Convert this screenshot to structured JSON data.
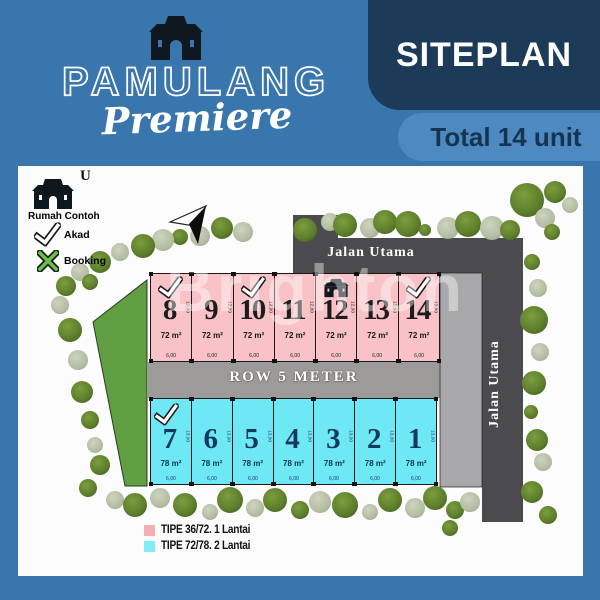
{
  "brand": {
    "name": "PAMULANG",
    "sub": "Premiere"
  },
  "header": {
    "title": "SITEPLAN",
    "subtitle": "Total 14 unit"
  },
  "legend": {
    "rumah_contoh": "Rumah Contoh",
    "akad": "Akad",
    "booking": "Booking"
  },
  "compass": {
    "label": "U"
  },
  "roads": {
    "top": "Jalan Utama",
    "right": "Jalan Utama",
    "middle": "ROW 5 METER"
  },
  "watermark": "Brighton",
  "rows": {
    "pink": {
      "area": "72 m²",
      "depth": "12,00",
      "width": "6,00",
      "units": [
        {
          "number": "8",
          "marker": "akad"
        },
        {
          "number": "9",
          "marker": null
        },
        {
          "number": "10",
          "marker": "akad"
        },
        {
          "number": "11",
          "marker": null
        },
        {
          "number": "12",
          "marker": "contoh"
        },
        {
          "number": "13",
          "marker": null
        },
        {
          "number": "14",
          "marker": "akad"
        }
      ]
    },
    "cyan": {
      "area": "78 m²",
      "depth": "13,00",
      "width": "6,00",
      "units": [
        {
          "number": "7",
          "marker": "akad"
        },
        {
          "number": "6",
          "marker": null
        },
        {
          "number": "5",
          "marker": null
        },
        {
          "number": "4",
          "marker": null
        },
        {
          "number": "3",
          "marker": null
        },
        {
          "number": "2",
          "marker": null
        },
        {
          "number": "1",
          "marker": null
        }
      ]
    }
  },
  "type_legend": [
    {
      "swatch_color": "#f5aeb4",
      "label": "TIPE 36/72. 1 Lantai"
    },
    {
      "swatch_color": "#7deef8",
      "label": "TIPE 72/78. 2 Lantai"
    }
  ],
  "colors": {
    "background_blue": "#3a76ae",
    "dark_navy": "#1c3b58",
    "total_box_blue": "#4c8ac1",
    "pink_unit": "#f8c2c7",
    "cyan_unit": "#6fe8f6",
    "main_road_gray": "#4b4b4f",
    "row_road_gray": "#9d9b99",
    "green_area": "#5f9e41"
  },
  "trees": [
    [
      287,
      64,
      12,
      "d"
    ],
    [
      312,
      56,
      9,
      "s"
    ],
    [
      327,
      59,
      12,
      "d"
    ],
    [
      352,
      62,
      10,
      "s"
    ],
    [
      367,
      56,
      12,
      "d"
    ],
    [
      390,
      58,
      13,
      "d"
    ],
    [
      407,
      64,
      6,
      "d"
    ],
    [
      430,
      62,
      11,
      "s"
    ],
    [
      450,
      58,
      13,
      "d"
    ],
    [
      474,
      62,
      12,
      "s"
    ],
    [
      492,
      64,
      10,
      "d"
    ],
    [
      509,
      34,
      17,
      "d"
    ],
    [
      527,
      52,
      10,
      "s"
    ],
    [
      534,
      66,
      8,
      "d"
    ],
    [
      537,
      26,
      11,
      "d"
    ],
    [
      552,
      39,
      8,
      "s"
    ],
    [
      514,
      96,
      8,
      "d"
    ],
    [
      520,
      122,
      9,
      "s"
    ],
    [
      516,
      154,
      14,
      "d"
    ],
    [
      522,
      186,
      9,
      "s"
    ],
    [
      516,
      217,
      12,
      "d"
    ],
    [
      513,
      246,
      7,
      "d"
    ],
    [
      519,
      274,
      11,
      "d"
    ],
    [
      525,
      296,
      9,
      "s"
    ],
    [
      514,
      326,
      11,
      "d"
    ],
    [
      530,
      349,
      9,
      "d"
    ],
    [
      225,
      66,
      10,
      "s"
    ],
    [
      204,
      62,
      11,
      "d"
    ],
    [
      182,
      70,
      10,
      "s"
    ],
    [
      162,
      71,
      8,
      "d"
    ],
    [
      145,
      74,
      11,
      "s"
    ],
    [
      125,
      80,
      12,
      "d"
    ],
    [
      102,
      86,
      9,
      "s"
    ],
    [
      82,
      96,
      11,
      "d"
    ],
    [
      62,
      106,
      9,
      "s"
    ],
    [
      48,
      120,
      10,
      "d"
    ],
    [
      72,
      116,
      8,
      "d"
    ],
    [
      42,
      139,
      9,
      "s"
    ],
    [
      52,
      164,
      12,
      "d"
    ],
    [
      60,
      194,
      10,
      "s"
    ],
    [
      64,
      226,
      11,
      "d"
    ],
    [
      72,
      254,
      9,
      "d"
    ],
    [
      77,
      279,
      8,
      "s"
    ],
    [
      82,
      299,
      10,
      "d"
    ],
    [
      70,
      322,
      9,
      "d"
    ],
    [
      97,
      334,
      9,
      "s"
    ],
    [
      117,
      339,
      12,
      "d"
    ],
    [
      142,
      332,
      10,
      "s"
    ],
    [
      167,
      339,
      12,
      "d"
    ],
    [
      192,
      346,
      8,
      "s"
    ],
    [
      212,
      334,
      13,
      "d"
    ],
    [
      237,
      342,
      9,
      "s"
    ],
    [
      257,
      334,
      12,
      "d"
    ],
    [
      282,
      344,
      9,
      "d"
    ],
    [
      302,
      336,
      11,
      "s"
    ],
    [
      327,
      339,
      13,
      "d"
    ],
    [
      352,
      346,
      8,
      "s"
    ],
    [
      372,
      334,
      12,
      "d"
    ],
    [
      397,
      342,
      10,
      "s"
    ],
    [
      417,
      332,
      12,
      "d"
    ],
    [
      437,
      344,
      9,
      "d"
    ],
    [
      452,
      336,
      10,
      "s"
    ],
    [
      432,
      362,
      8,
      "d"
    ]
  ]
}
